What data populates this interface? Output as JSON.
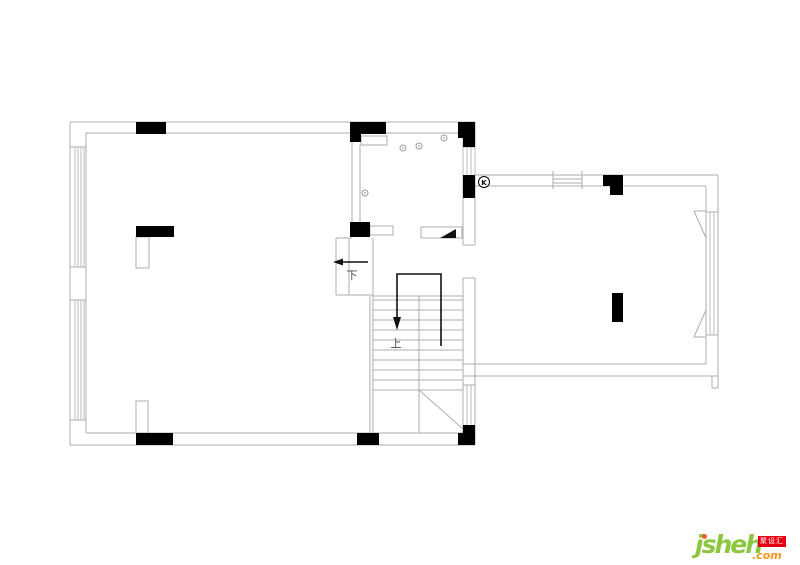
{
  "page": {
    "background": "#ffffff"
  },
  "plan": {
    "type": "architectural-floor-plan",
    "labels": {
      "stair_down": "下",
      "stair_up": "上",
      "meter_symbol": "K"
    },
    "colors": {
      "wall_line": "#aeaeae",
      "column_fill": "#000000",
      "annotation_text": "#4a4a4a"
    }
  },
  "logo": {
    "wordmark": "jsheh",
    "tld": ".com",
    "badge_text": "聚设汇",
    "colors": {
      "wordmark": "#8dc63f",
      "j_dot": "#f15a24",
      "tld": "#f7941d",
      "badge_bg": "#e60012",
      "badge_text": "#ffffff"
    }
  }
}
